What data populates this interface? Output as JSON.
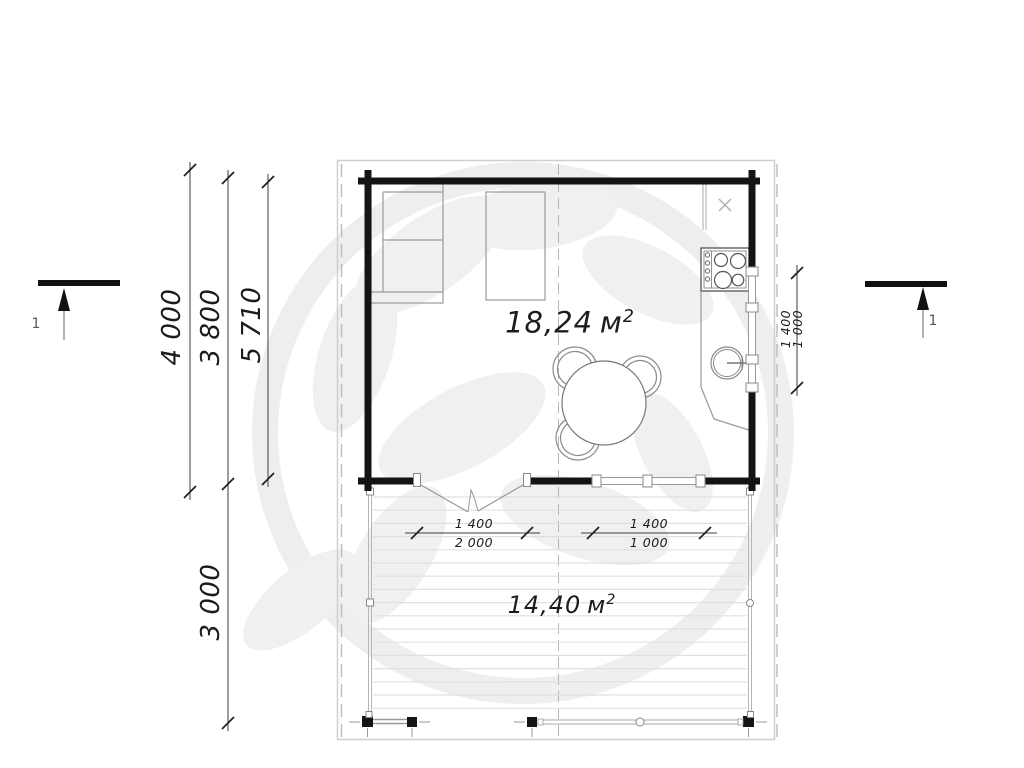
{
  "plan": {
    "room": {
      "area_value": "18,24",
      "area_unit": "м",
      "area_sup": "2"
    },
    "terrace": {
      "area_value": "14,40",
      "area_unit": "м",
      "area_sup": "2"
    },
    "dimensions": {
      "left_outer": "4 000",
      "left_inner": "3 800",
      "left_total": "5 710",
      "terrace_depth": "3 000",
      "door_width": "1 400",
      "door_opening_width": "2 000",
      "terrace_window_width": "1 400",
      "terrace_window_height": "1 000",
      "side_window_width": "1 400",
      "side_window_height": "1 000"
    },
    "section_markers": {
      "left_label": "1",
      "right_label": "1"
    }
  },
  "colors": {
    "wall": "#141414",
    "dimension_line": "#3d3d3d",
    "thin_line": "#9a9a9a",
    "boundary": "#cfcfcf",
    "watermark": "#ededed"
  }
}
